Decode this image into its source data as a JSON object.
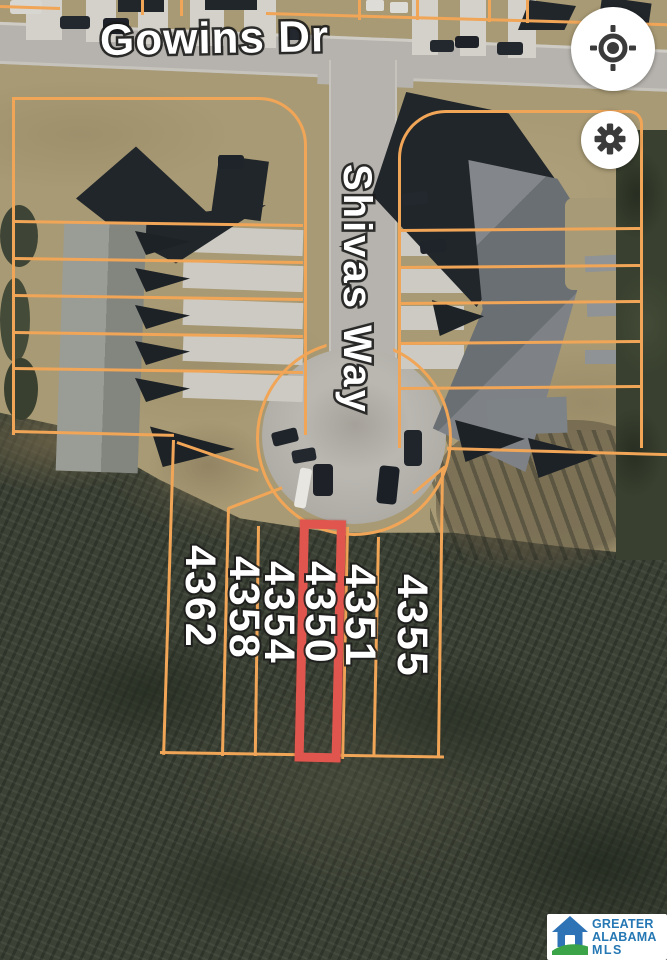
{
  "app": {
    "type": "aerial-parcel-map-view"
  },
  "map": {
    "streets": [
      {
        "label": "Gowins Dr"
      },
      {
        "label": "Shivas Way"
      }
    ],
    "lots": [
      {
        "number": "4362",
        "highlighted": false
      },
      {
        "number": "4358",
        "highlighted": false
      },
      {
        "number": "4354",
        "highlighted": false
      },
      {
        "number": "4350",
        "highlighted": true
      },
      {
        "number": "4351",
        "highlighted": false
      },
      {
        "number": "4355",
        "highlighted": false
      }
    ],
    "highlighted_lot": "4350",
    "colors": {
      "parcel_line": "#F1A557",
      "highlight_outline": "#E0564E"
    }
  },
  "controls": {
    "locate_button": {
      "icon": "crosshair-icon"
    },
    "settings_button": {
      "icon": "gear-icon"
    }
  },
  "branding": {
    "logo_lines": [
      "GREATER",
      "ALABAMA",
      "MLS"
    ],
    "colors": {
      "blue": "#2578B3",
      "green": "#3BA449"
    }
  }
}
